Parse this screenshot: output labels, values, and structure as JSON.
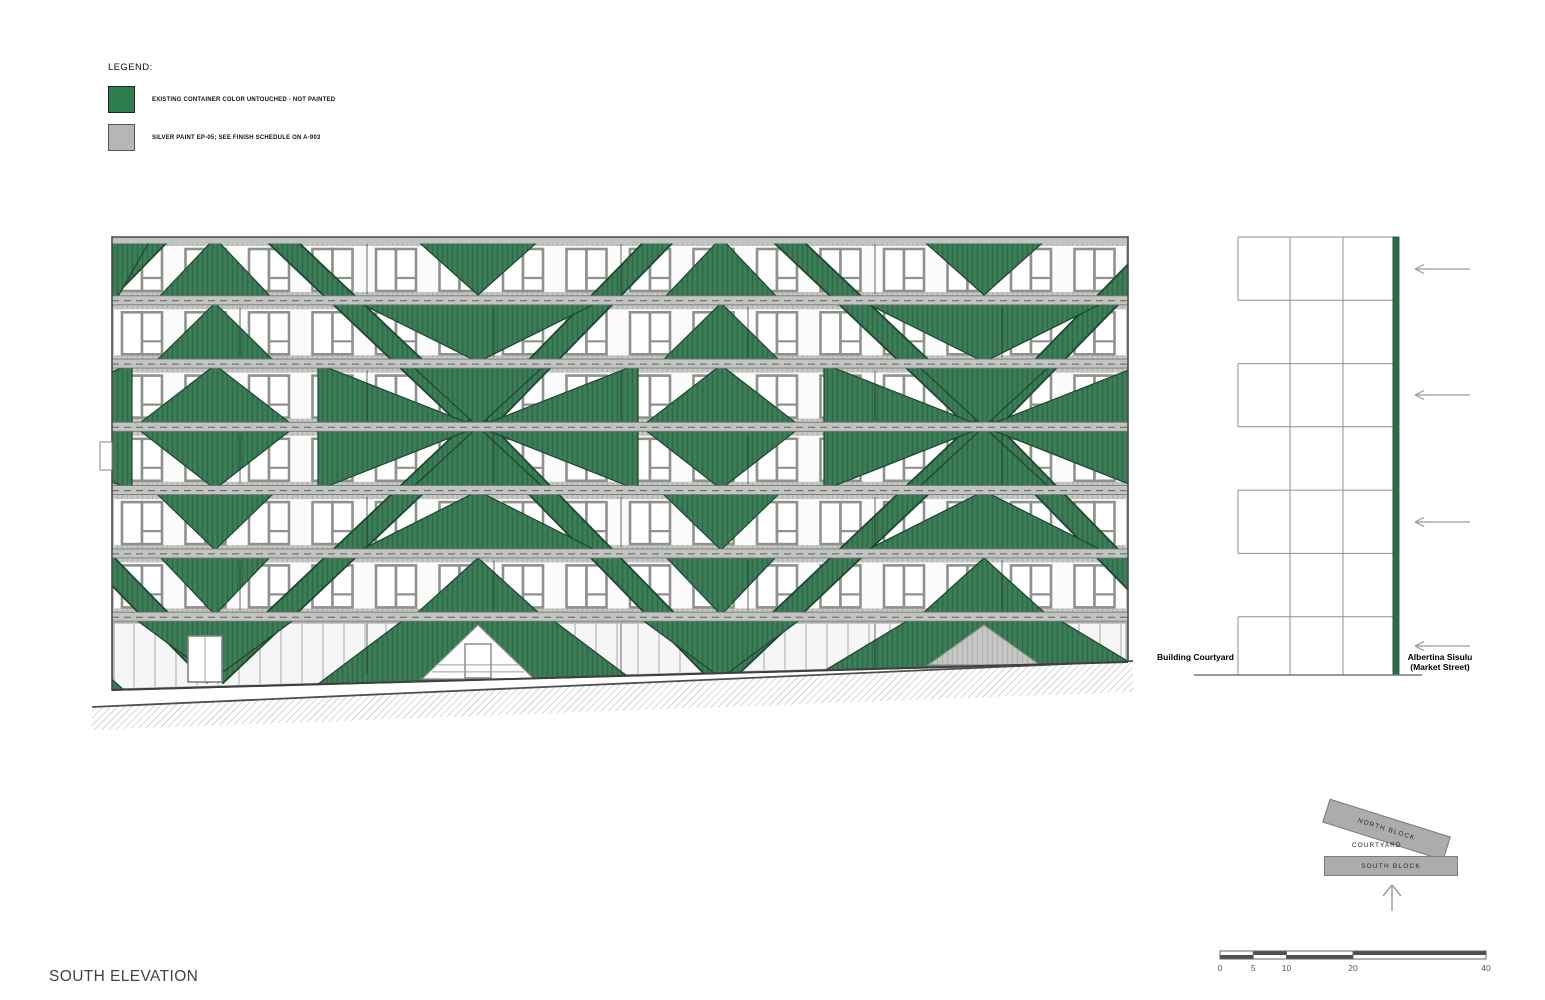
{
  "title": "SOUTH ELEVATION",
  "legend": {
    "title": "LEGEND:",
    "items": [
      {
        "label": "EXISTING CONTAINER COLOR UNTOUCHED - NOT PAINTED",
        "color": "#2E7D4F",
        "border": "#222222"
      },
      {
        "label": "SILVER PAINT EP-05; SEE FINISH SCHEDULE ON A-903",
        "color": "#B5B7B5",
        "border": "#555555"
      }
    ]
  },
  "section": {
    "left_label": "Building Courtyard",
    "right_label_line1": "Albertina Sisulu",
    "right_label_line2": "(Market Street)"
  },
  "keyplan": {
    "north_label": "NORTH BLOCK",
    "courtyard_label": "COURTYARD",
    "south_label": "SOUTH BLOCK"
  },
  "scalebar": {
    "labels": [
      "0",
      "5",
      "10",
      "20",
      "40"
    ],
    "values": [
      0,
      5,
      10,
      20,
      40
    ],
    "units_total": 40
  },
  "colors": {
    "green": "#3B7E57",
    "green_line": "#2F6847",
    "green_dark": "#1D4631",
    "silver": "#C6C8C6",
    "silver_line": "#B1B3B1",
    "rail": "#C2C4C2",
    "rail_line": "#777777",
    "window_frame": "#8F928C",
    "glass": "#FFFFFF",
    "strip_white": "#FBFBFB",
    "outline": "#4A4A4A",
    "hatch_line": "#ABABAB",
    "grade_line": "#4F4F4F",
    "grid": "#909090",
    "arrow": "#9A9A9A",
    "section_green": "#2E6B4A",
    "scale_dark": "#4F4F4F",
    "scale_text": "#555555",
    "mullion": "#A9ACA7"
  }
}
